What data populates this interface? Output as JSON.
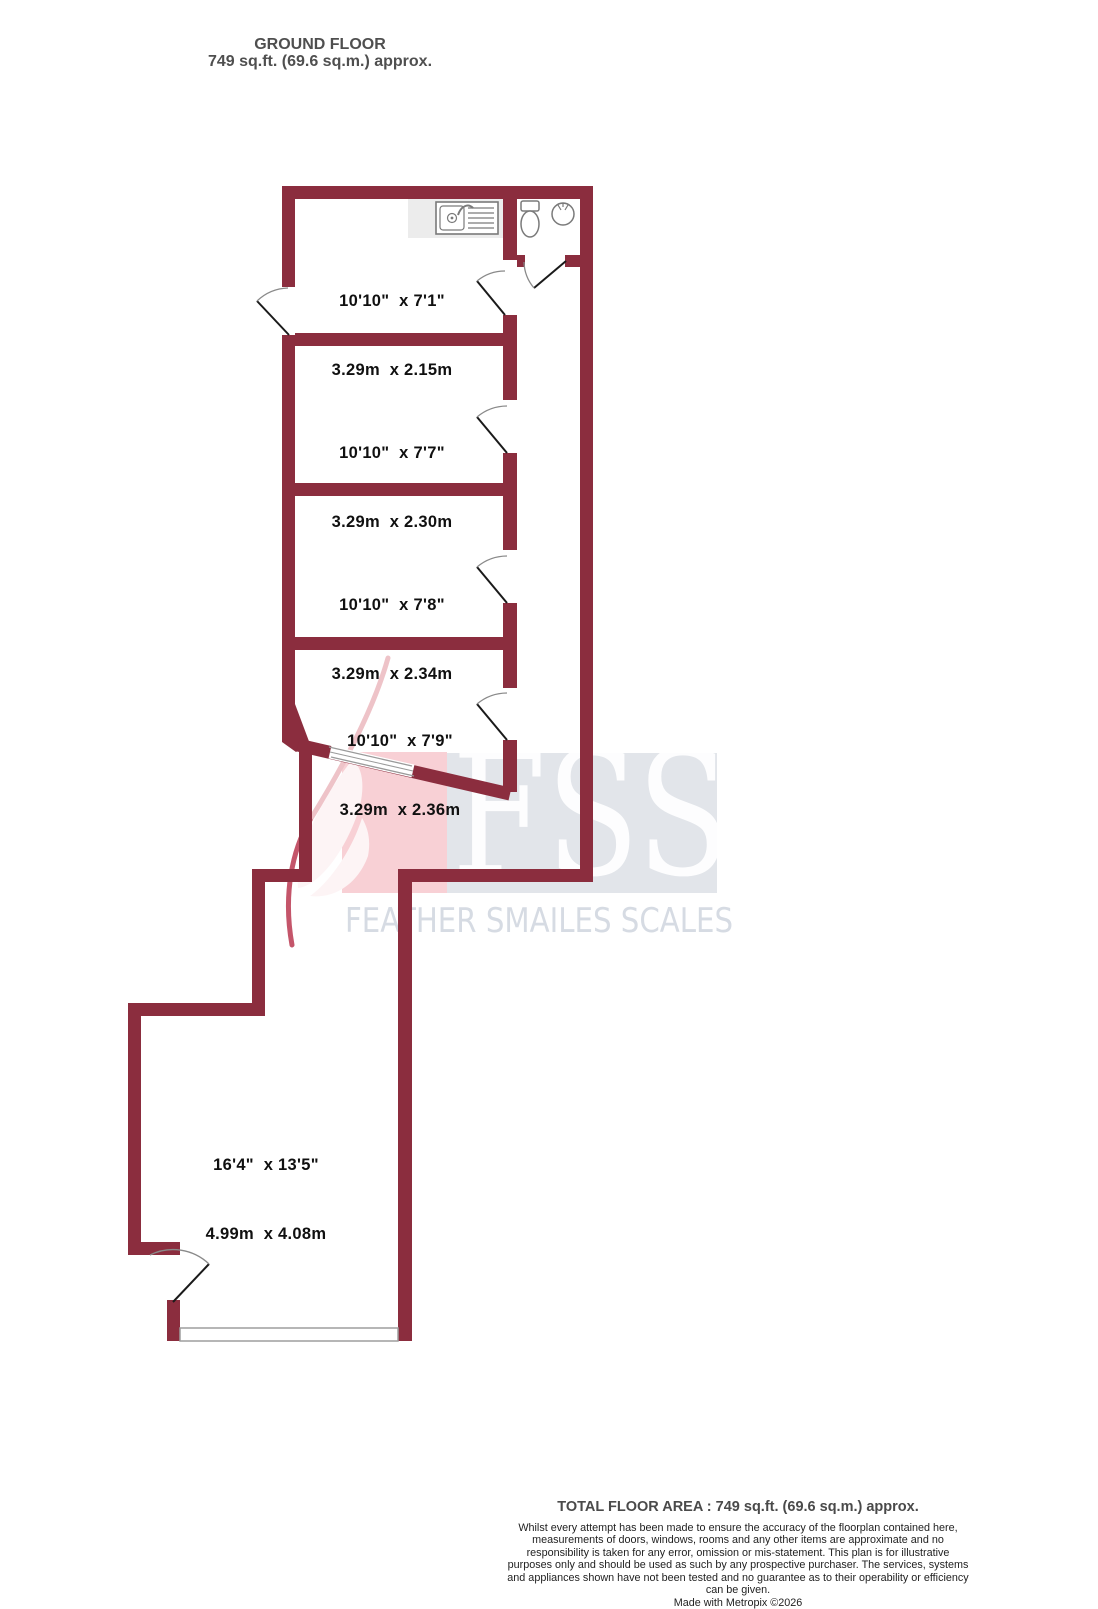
{
  "title": {
    "line1": "GROUND FLOOR",
    "line2": "749 sq.ft. (69.6 sq.m.) approx."
  },
  "rooms": [
    {
      "imperial": "10'10\"  x 7'1\"",
      "metric": "3.29m  x 2.15m"
    },
    {
      "imperial": "10'10\"  x 7'7\"",
      "metric": "3.29m  x 2.30m"
    },
    {
      "imperial": "10'10\"  x 7'8\"",
      "metric": "3.29m  x 2.34m"
    },
    {
      "imperial": "10'10\"  x 7'9\"",
      "metric": "3.29m  x 2.36m"
    },
    {
      "imperial": "16'4\"  x 13'5\"",
      "metric": "4.99m  x 4.08m"
    }
  ],
  "fixtures": {
    "sink": "kitchen-sink-icon",
    "toilet": "toilet-icon",
    "basin": "wash-basin-icon",
    "feather": "feather-logo-icon"
  },
  "watermark": {
    "logo": "FSS",
    "company": "FEATHER SMAILES SCALES"
  },
  "footer": {
    "total": "TOTAL FLOOR AREA : 749 sq.ft. (69.6 sq.m.) approx.",
    "disclaimer": "Whilst every attempt has been made to ensure the accuracy of the floorplan contained here, measurements of doors, windows, rooms and any other items are approximate and no responsibility is taken for any error, omission or mis-statement. This plan is for illustrative purposes only and should be used as such by any prospective purchaser. The services, systems and appliances shown have not been tested and no guarantee as to their operability or efficiency can be given.",
    "credit": "Made with Metropix ©2026"
  },
  "colors": {
    "wall": "#8b2d3e",
    "watermark_pink": "#f8d0d5",
    "watermark_gray": "#e2e5ea",
    "watermark_text": "#d6dbe3",
    "counter_gray": "#ececec"
  }
}
